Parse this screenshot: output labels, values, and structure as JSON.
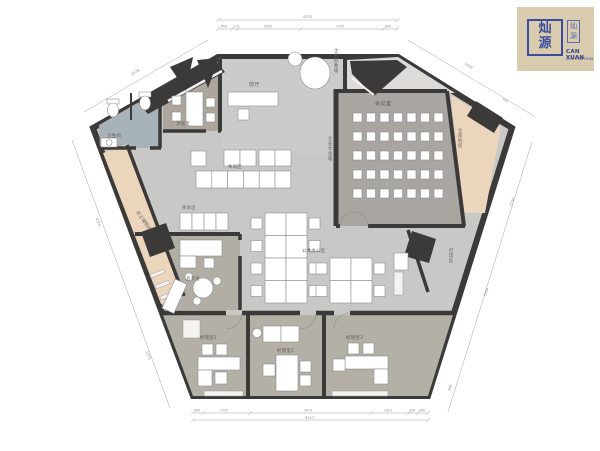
{
  "logo": {
    "seal_top_char": "灿",
    "seal_bottom_char": "源",
    "side_seal_text": "灿源",
    "company_line1": "CAN YUAN",
    "company_line2": "DECORATION"
  },
  "rooms": {
    "lobby": "前厅",
    "negotiation_room": "洽谈室",
    "restroom": "卫生间",
    "staff_storage": "员工储物间",
    "tea_station": "茶水区",
    "lounge": "休闲区",
    "image_wall": "企业形象墙",
    "culture_wall": "企业文化墙",
    "meeting_room": "会议室",
    "warehouse_room": "仓库机房",
    "open_office": "公共办公区",
    "print_zone": "打印区",
    "tea_room": "品茶室",
    "manager_1": "经理室1",
    "manager_2": "经理室2",
    "manager_3": "经理室3"
  },
  "dimensions": {
    "top_total": "4552",
    "top_segments": [
      "650",
      "270",
      "2900",
      "3765",
      "650"
    ],
    "bottom_total": "9517",
    "bottom_segments": [
      "360",
      "1737",
      "4479",
      "1421",
      "330",
      "360"
    ],
    "left_top_diagonal": "2478",
    "right_top_diagonal": "1929",
    "right_top_inner": "726",
    "left_side_a": "4205",
    "left_side_b": "1575",
    "right_side_a": "3136",
    "right_side_b": "5334",
    "right_side_c": "890"
  },
  "furniture": {
    "meeting_seats": {
      "rows": 5,
      "cols": 7
    },
    "open_office_cluster_a": {
      "rows": 4,
      "cols": 2
    },
    "open_office_cluster_b": {
      "rows": 2,
      "cols": 2
    }
  },
  "colors": {
    "wall": "#3b3a38",
    "floor": "#c8c8c6",
    "lobby_floor": "#cbcbc9",
    "vestibule": "#dcdbd8",
    "meeting_room": "#a9a5a0",
    "office_row": "#b4afa7",
    "negotiation": "#aca69e",
    "tea_room": "#b2ada5",
    "restroom": "#a8b2b9",
    "storage": "#ecd5bd",
    "warehouse": "#ecd5bd",
    "logo_bg": "#d9ccae",
    "seal_blue": "#3c4da0"
  }
}
